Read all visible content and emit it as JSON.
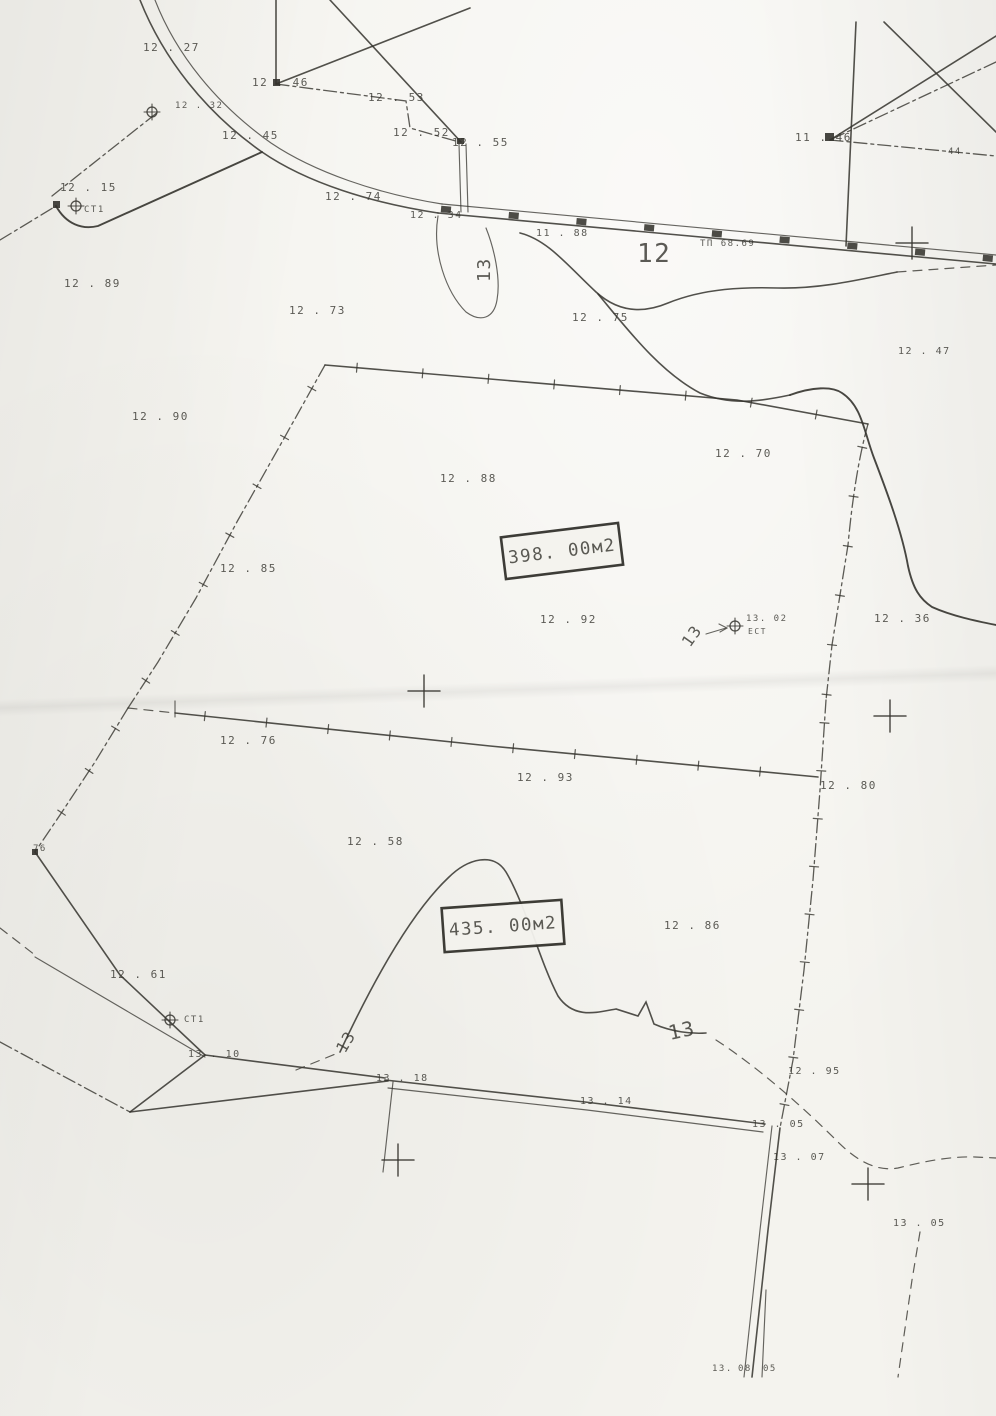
{
  "map": {
    "colors": {
      "ink": "#34332d",
      "paper": "#f4f3ee"
    },
    "area_labels": [
      {
        "text": "398. 00м2",
        "cx": 562,
        "cy": 551,
        "w": 118,
        "h": 42,
        "rot": -7
      },
      {
        "text": "435. 00м2",
        "cx": 503,
        "cy": 926,
        "w": 120,
        "h": 44,
        "rot": -4
      }
    ],
    "spot_elevations": [
      {
        "text": "12 . 27",
        "x": 143,
        "y": 51,
        "size": 11
      },
      {
        "text": "12 . 46",
        "x": 252,
        "y": 86,
        "size": 11
      },
      {
        "text": "12 . 53",
        "x": 368,
        "y": 101,
        "size": 11
      },
      {
        "text": "12 . 52",
        "x": 393,
        "y": 136,
        "size": 11
      },
      {
        "text": "12 . 55",
        "x": 452,
        "y": 146,
        "size": 11
      },
      {
        "text": "12 . 45",
        "x": 222,
        "y": 139,
        "size": 11
      },
      {
        "text": "12 . 32",
        "x": 175,
        "y": 108,
        "size": 9
      },
      {
        "text": "12 . 15",
        "x": 60,
        "y": 191,
        "size": 11
      },
      {
        "text": "СТ1",
        "x": 84,
        "y": 212,
        "size": 9
      },
      {
        "text": "12 . 74",
        "x": 325,
        "y": 200,
        "size": 11
      },
      {
        "text": "12 . 34",
        "x": 410,
        "y": 218,
        "size": 10
      },
      {
        "text": "11 . 88",
        "x": 536,
        "y": 236,
        "size": 10
      },
      {
        "text": "ТП 68.69",
        "x": 700,
        "y": 246,
        "size": 9
      },
      {
        "text": "11 . 46",
        "x": 795,
        "y": 141,
        "size": 11
      },
      {
        "text": "44",
        "x": 948,
        "y": 154,
        "size": 9
      },
      {
        "text": "12 . 89",
        "x": 64,
        "y": 287,
        "size": 11
      },
      {
        "text": "12 . 73",
        "x": 289,
        "y": 314,
        "size": 11
      },
      {
        "text": "12 . 75",
        "x": 572,
        "y": 321,
        "size": 11
      },
      {
        "text": "12 . 47",
        "x": 898,
        "y": 354,
        "size": 10
      },
      {
        "text": "12 . 90",
        "x": 132,
        "y": 420,
        "size": 11
      },
      {
        "text": "12 . 70",
        "x": 715,
        "y": 457,
        "size": 11
      },
      {
        "text": "12 . 88",
        "x": 440,
        "y": 482,
        "size": 11
      },
      {
        "text": "12 . 85",
        "x": 220,
        "y": 572,
        "size": 11
      },
      {
        "text": "12 . 92",
        "x": 540,
        "y": 623,
        "size": 11
      },
      {
        "text": "13. 02",
        "x": 746,
        "y": 621,
        "size": 9
      },
      {
        "text": "ЕСТ",
        "x": 748,
        "y": 634,
        "size": 8
      },
      {
        "text": "12 . 36",
        "x": 874,
        "y": 622,
        "size": 11
      },
      {
        "text": "12 . 76",
        "x": 220,
        "y": 744,
        "size": 11
      },
      {
        "text": "12 . 93",
        "x": 517,
        "y": 781,
        "size": 11
      },
      {
        "text": "12 . 80",
        "x": 820,
        "y": 789,
        "size": 11
      },
      {
        "text": "12 . 58",
        "x": 347,
        "y": 845,
        "size": 11
      },
      {
        "text": "76",
        "x": 33,
        "y": 851,
        "size": 9
      },
      {
        "text": "12 . 86",
        "x": 664,
        "y": 929,
        "size": 11
      },
      {
        "text": "12 . 61",
        "x": 110,
        "y": 978,
        "size": 11
      },
      {
        "text": "СТ1",
        "x": 184,
        "y": 1022,
        "size": 9
      },
      {
        "text": "13 . 10",
        "x": 188,
        "y": 1057,
        "size": 10
      },
      {
        "text": "13 . 18",
        "x": 376,
        "y": 1081,
        "size": 10
      },
      {
        "text": "13 . 14",
        "x": 580,
        "y": 1104,
        "size": 10
      },
      {
        "text": "13 . 05",
        "x": 752,
        "y": 1127,
        "size": 10
      },
      {
        "text": "12 . 95",
        "x": 788,
        "y": 1074,
        "size": 10
      },
      {
        "text": "13 . 07",
        "x": 773,
        "y": 1160,
        "size": 10
      },
      {
        "text": "13 . 05",
        "x": 893,
        "y": 1226,
        "size": 10
      },
      {
        "text": "13.",
        "x": 712,
        "y": 1371,
        "size": 9
      },
      {
        "text": "08",
        "x": 738,
        "y": 1371,
        "size": 9
      },
      {
        "text": "05",
        "x": 763,
        "y": 1371,
        "size": 9
      }
    ],
    "contour_labels": [
      {
        "text": "12",
        "x": 637,
        "y": 262,
        "size": 26,
        "rot": 0
      },
      {
        "text": "13",
        "x": 490,
        "y": 282,
        "size": 18,
        "rot": -90
      },
      {
        "text": "13",
        "x": 690,
        "y": 648,
        "size": 16,
        "rot": -55
      },
      {
        "text": "13",
        "x": 345,
        "y": 1054,
        "size": 16,
        "rot": -60
      },
      {
        "text": "13",
        "x": 670,
        "y": 1040,
        "size": 20,
        "rot": -12
      }
    ],
    "grid_crosses": [
      {
        "x": 912,
        "y": 243
      },
      {
        "x": 424,
        "y": 691
      },
      {
        "x": 890,
        "y": 716
      },
      {
        "x": 398,
        "y": 1160
      },
      {
        "x": 868,
        "y": 1184
      }
    ],
    "station_markers": [
      {
        "x": 152,
        "y": 112
      },
      {
        "x": 76,
        "y": 206
      },
      {
        "x": 735,
        "y": 626
      },
      {
        "x": 170,
        "y": 1020
      }
    ]
  }
}
